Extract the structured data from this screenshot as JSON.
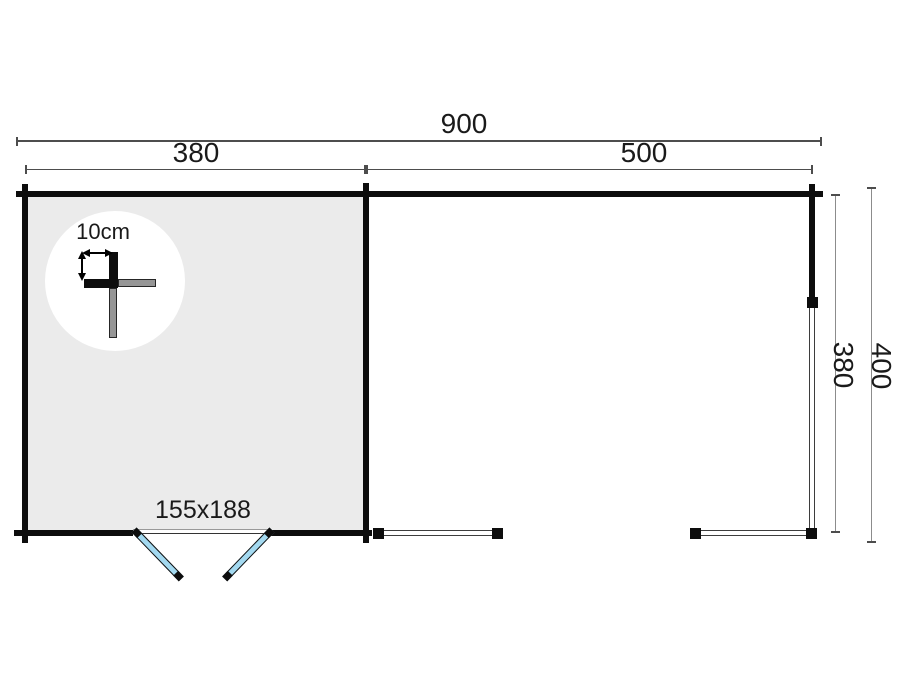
{
  "drawing": {
    "type": "cabin-floor-plan"
  },
  "colors": {
    "bg": "#ffffff",
    "wall": "#0d0d0d",
    "floor": "#ebebeb",
    "dim": "#4d4d4d",
    "dimlight": "#8c8c8c",
    "beam": "#3d3d3d",
    "door": "#a3d9f0",
    "loggray": "#969696"
  },
  "dims": {
    "total_width": "900",
    "cabin_width": "380",
    "canopy_width": "500",
    "depth_inner": "380",
    "depth_outer": "400"
  },
  "labels": {
    "door_size": "155x188",
    "wall_thickness": "10cm"
  }
}
